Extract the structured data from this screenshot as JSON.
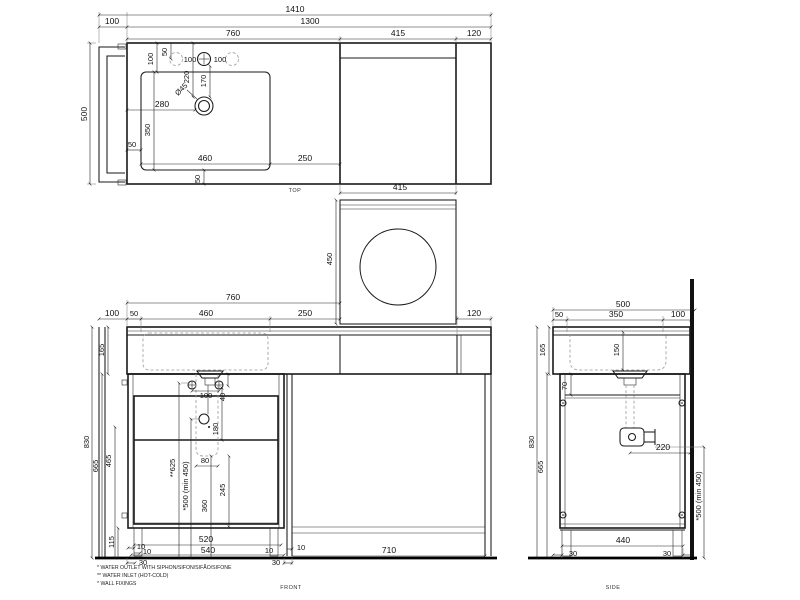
{
  "background": "#ffffff",
  "line_color": "#1a1a1a",
  "views": {
    "top": {
      "title": "TOP",
      "dims": {
        "overall": "1410",
        "rail_offset": "100",
        "cabinet_width": "1300",
        "left_section": "760",
        "wm_section": "415",
        "right_section": "120",
        "depth": "500",
        "back_to_sink": "100",
        "back_to_taps": "50",
        "back_to_hole": "220",
        "taps_to_hole": "170",
        "hole_dia": "Ø45",
        "tap_left": "100",
        "tap_right": "100",
        "edge_to_hole": "280",
        "sink_depth": "350",
        "sink_width": "460",
        "sink_to_wm": "250",
        "edge_gap": "50",
        "front_gap": "50"
      }
    },
    "wm": {
      "dims": {
        "width": "415",
        "height": "450"
      }
    },
    "front": {
      "title": "FRONT",
      "dims": {
        "left_section": "760",
        "rail_offset": "100",
        "edge_gap": "50",
        "sink_width": "460",
        "sink_to_wm": "250",
        "right_panel": "120",
        "apron": "165",
        "height": "830",
        "under_counter": "665",
        "clearance": "465",
        "plinth": "115",
        "fixing_spacing": "100",
        "fixing_drop": "40",
        "outlet_drop": "180",
        "inlet_height": "**625",
        "outlet_height": "*500 (min 450)",
        "trap_width": "80",
        "trap_height": "360",
        "base_clear": "245",
        "gap1": "10",
        "gap2": "10",
        "inset1": "30",
        "drawer_width": "520",
        "box_width": "540",
        "gap3": "10",
        "inset2": "30",
        "gap4": "10",
        "opening": "710"
      },
      "notes": [
        "* WATER OUTLET WITH SIPHON/SIFON/SIFÃO/SIFONE",
        "** WATER INLET  (HOT-COLD)",
        "* WALL FIXINGS"
      ]
    },
    "side": {
      "title": "SIDE",
      "dims": {
        "depth": "500",
        "overhang": "50",
        "basin_depth": "350",
        "to_wall": "100",
        "apron": "165",
        "height": "830",
        "under_counter": "665",
        "bowl_depth": "150",
        "top_rail": "70",
        "outlet_to_wall": "220",
        "outlet_height": "*500 (min 450)",
        "base_depth": "440",
        "inset_front": "30",
        "inset_back": "30"
      }
    }
  }
}
